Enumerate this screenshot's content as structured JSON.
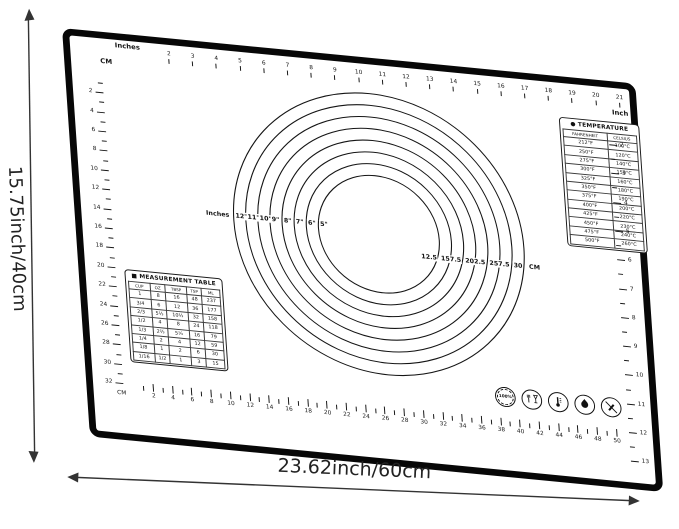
{
  "dimensions": {
    "height_label": "15.75inch/40cm",
    "width_label": "23.62inch/60cm"
  },
  "rulers": {
    "top": {
      "start_label": "Inches",
      "end_label": "Inch",
      "numbers": [
        2,
        3,
        4,
        5,
        6,
        7,
        8,
        9,
        10,
        11,
        12,
        13,
        14,
        15,
        16,
        17,
        18,
        19,
        20,
        21
      ]
    },
    "left": {
      "unit": "CM",
      "numbers": [
        2,
        4,
        6,
        8,
        10,
        12,
        14,
        16,
        18,
        20,
        22,
        24,
        26,
        28,
        30,
        32
      ]
    },
    "bottom": {
      "unit": "CM",
      "numbers": [
        2,
        4,
        6,
        8,
        10,
        12,
        14,
        16,
        18,
        20,
        22,
        24,
        26,
        28,
        30,
        32,
        34,
        36,
        38,
        40,
        42,
        44,
        46,
        48,
        50
      ]
    },
    "right": {
      "unit": "Inch",
      "numbers": [
        2,
        3,
        4,
        5,
        6,
        7,
        8,
        9,
        10,
        11,
        12,
        13
      ]
    }
  },
  "circles": {
    "inches_prefix": "Inches",
    "cm_suffix": "CM",
    "rings": [
      {
        "inch": "12\"",
        "cm": "30"
      },
      {
        "inch": "11\"",
        "cm": "27.5"
      },
      {
        "inch": "10\"",
        "cm": "25"
      },
      {
        "inch": "9\"",
        "cm": "22.5"
      },
      {
        "inch": "8\"",
        "cm": "20"
      },
      {
        "inch": "7\"",
        "cm": "17.5"
      },
      {
        "inch": "6\"",
        "cm": "15"
      },
      {
        "inch": "5\"",
        "cm": "12.5"
      }
    ]
  },
  "temperature_table": {
    "bullet": "●",
    "title": "TEMPERATURE",
    "columns": [
      "FAHRENHEIT",
      "CELSIUS"
    ],
    "rows": [
      [
        "212°F",
        "100°C"
      ],
      [
        "250°F",
        "120°C"
      ],
      [
        "275°F",
        "140°C"
      ],
      [
        "300°F",
        "150°C"
      ],
      [
        "325°F",
        "160°C"
      ],
      [
        "350°F",
        "180°C"
      ],
      [
        "375°F",
        "190°C"
      ],
      [
        "400°F",
        "200°C"
      ],
      [
        "425°F",
        "220°C"
      ],
      [
        "450°F",
        "230°C"
      ],
      [
        "475°F",
        "240°C"
      ],
      [
        "500°F",
        "260°C"
      ]
    ]
  },
  "measurement_table": {
    "bullet": "■",
    "title": "MEASUREMENT TABLE",
    "columns": [
      "CUP",
      "OZ",
      "TBSP",
      "TSP",
      "ML"
    ],
    "rows": [
      [
        "1",
        "8",
        "16",
        "48",
        "237"
      ],
      [
        "3/4",
        "6",
        "12",
        "36",
        "177"
      ],
      [
        "2/3",
        "5⅓",
        "10⅔",
        "32",
        "158"
      ],
      [
        "1/2",
        "4",
        "8",
        "24",
        "118"
      ],
      [
        "1/3",
        "2⅔",
        "5⅓",
        "16",
        "79"
      ],
      [
        "1/4",
        "2",
        "4",
        "12",
        "59"
      ],
      [
        "1/8",
        "1",
        "2",
        "6",
        "30"
      ],
      [
        "1/16",
        "1/2",
        "1",
        "3",
        "15"
      ]
    ]
  },
  "badges": {
    "percent_label": "100%",
    "icons": [
      "100-percent-seal-icon",
      "food-safe-icon",
      "temperature-resistant-icon",
      "flame-resistant-icon",
      "no-knife-icon"
    ]
  },
  "colors": {
    "ink": "#151515",
    "border": "#070707",
    "annotation": "#333333"
  }
}
